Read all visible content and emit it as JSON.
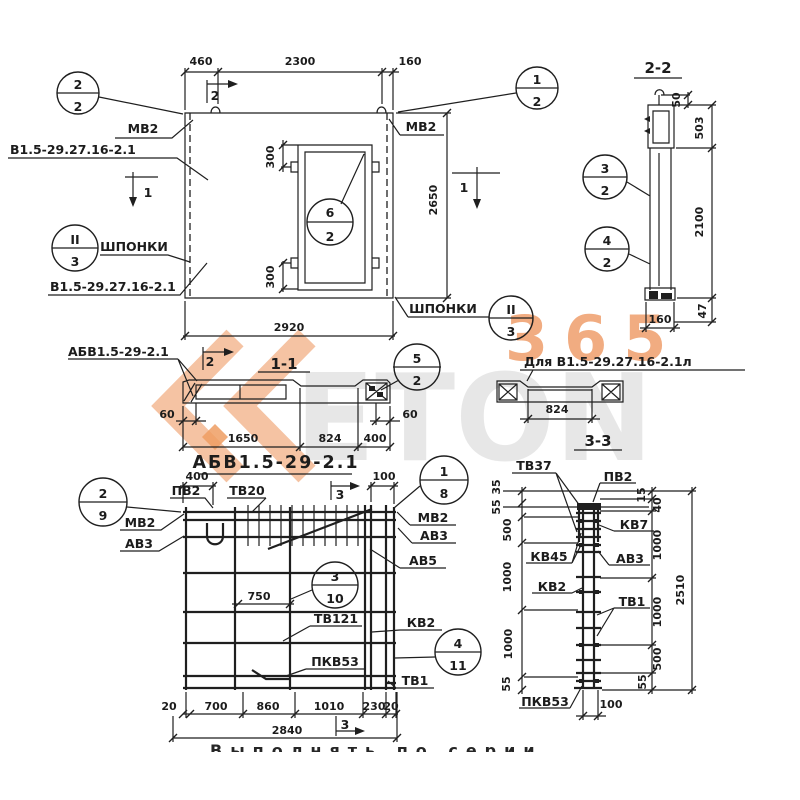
{
  "colors": {
    "ink": "#1f1f1f",
    "watermark_orange": "#efa26e",
    "watermark_gray": "#d6d6d6",
    "paper": "#ffffff"
  },
  "plan": {
    "dim_460": "460",
    "dim_2300": "2300",
    "dim_160": "160",
    "dim_300_top": "300",
    "dim_300_bottom": "300",
    "dim_2650": "2650",
    "dim_2920": "2920",
    "label_mv2_left": "МВ2",
    "label_mv2_right": "МВ2",
    "mark_top": "В1.5-29.27.16-2.1",
    "mark_bottom": "В1.5-29.27.16-2.1",
    "shponki_left": "ШПОНКИ",
    "shponki_right": "ШПОНКИ",
    "cut2": "2",
    "cut1_left": "1",
    "cut1_right": "1",
    "c22_top": "2",
    "c22_bot": "2",
    "c12_top": "1",
    "c12_bot": "2",
    "c62_top": "6",
    "c62_bot": "2",
    "cII3_left_top": "II",
    "cII3_left_bot": "3",
    "cII3_right_top": "II",
    "cII3_right_bot": "3"
  },
  "sec22": {
    "title": "2-2",
    "dim_50": "50",
    "dim_503": "503",
    "dim_2100": "2100",
    "dim_47": "47",
    "dim_160": "160",
    "c32_top": "3",
    "c32_bot": "2",
    "c42_top": "4",
    "c42_bot": "2"
  },
  "sec11": {
    "title": "1-1",
    "label": "АБВ1.5-29-2.1",
    "cut2": "2",
    "dim_60_left": "60",
    "dim_1650": "1650",
    "dim_824": "824",
    "dim_400": "400",
    "dim_60_right": "60",
    "c52_top": "5",
    "c52_bot": "2"
  },
  "detail_l": {
    "label": "Для В1.5-29.27.16-2.1л",
    "dim_824": "824"
  },
  "rebar": {
    "title": "АБВ1.5-29-2.1",
    "dim_400": "400",
    "dim_100": "100",
    "dim_750": "750",
    "label_pv2": "ПВ2",
    "label_tv20": "ТВ20",
    "label_mv2_left": "МВ2",
    "label_av3_left": "АВ3",
    "label_mv2_right": "МВ2",
    "label_av3_right": "АВ3",
    "label_av5": "АВ5",
    "label_tv121": "ТВ121",
    "label_kv2": "КВ2",
    "label_tv1": "ТВ1",
    "label_pkv53": "ПКВ53",
    "cut3_top": "3",
    "cut3_bottom": "3",
    "c29_top": "2",
    "c29_bot": "9",
    "c18_top": "1",
    "c18_bot": "8",
    "c310_top": "3",
    "c310_bot": "10",
    "c411_top": "4",
    "c411_bot": "11",
    "dims_bottom": [
      "20",
      "700",
      "860",
      "1010",
      "230",
      "20"
    ],
    "dim_2840": "2840"
  },
  "sec33": {
    "title": "3-3",
    "label_tv37": "ТВ37",
    "label_pv2": "ПВ2",
    "label_kv7": "КВ7",
    "label_kv45": "КВ45",
    "label_av3": "АВ3",
    "label_kv2": "КВ2",
    "label_tv1": "ТВ1",
    "label_pkv53": "ПКВ53",
    "dims_left": [
      "35",
      "55",
      "500",
      "1000",
      "1000",
      "55"
    ],
    "dims_right": [
      "15",
      "40",
      "1000",
      "1000",
      "500",
      "55"
    ],
    "dim_2510": "2510",
    "dim_100": "100"
  },
  "watermark": {
    "word": "ETON",
    "number": "365"
  },
  "caption_cut": "Выполнять по серии"
}
